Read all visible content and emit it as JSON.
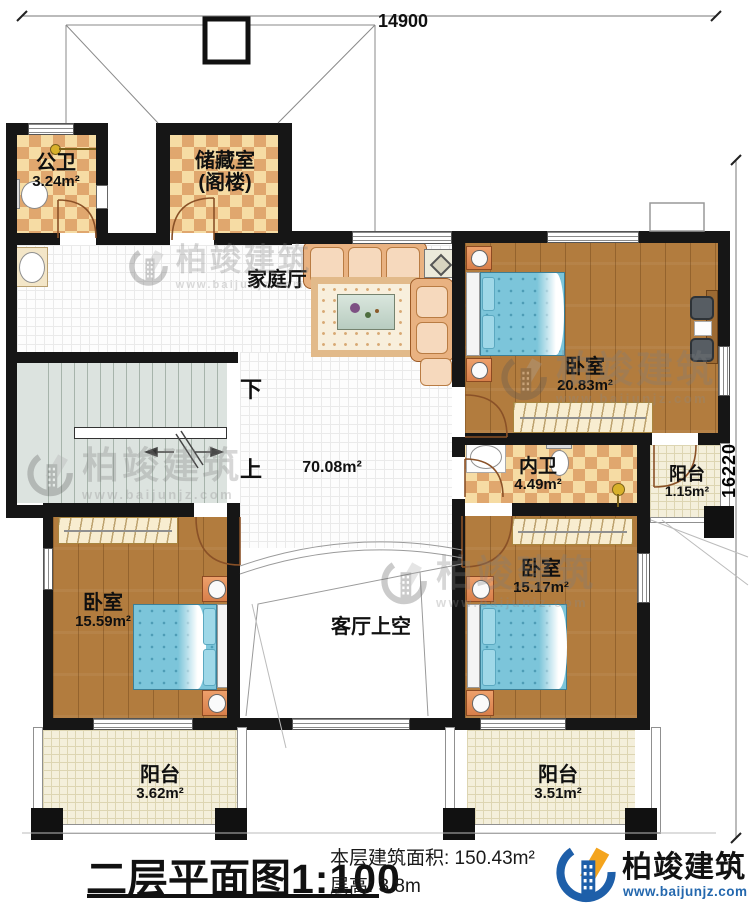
{
  "dims": {
    "top": "14900",
    "right": "16220"
  },
  "rooms": {
    "gongwei": {
      "name": "公卫",
      "area": "3.24m²"
    },
    "chucang": {
      "name": "储藏室",
      "sub": "(阁楼)"
    },
    "jiating": {
      "name": "家庭厅"
    },
    "hall": {
      "area": "70.08m²"
    },
    "bed_tr": {
      "name": "卧室",
      "area": "20.83m²"
    },
    "neiwei": {
      "name": "内卫",
      "area": "4.49m²"
    },
    "yt_r": {
      "name": "阳台",
      "area": "1.15m²"
    },
    "bed_bl": {
      "name": "卧室",
      "area": "15.59m²"
    },
    "bed_br": {
      "name": "卧室",
      "area": "15.17m²"
    },
    "keting": {
      "name": "客厅上空"
    },
    "yt_bl": {
      "name": "阳台",
      "area": "3.62m²"
    },
    "yt_br": {
      "name": "阳台",
      "area": "3.51m²"
    }
  },
  "stairs": {
    "down": "下",
    "up": "上"
  },
  "title": {
    "main": "二层平面图",
    "scale": "1:100",
    "area_label": "本层建筑面积: 150.43m²",
    "height_label": "层高: 3.8m"
  },
  "brand": {
    "name": "柏竣建筑",
    "url": "www.baijunjz.com"
  },
  "colors": {
    "wall": "#161616",
    "wood": "#b27c3e",
    "checker": "#e0a76e",
    "stair": "#dce3df",
    "bed": "#7cc5da",
    "brand_blue": "#1e5fa9",
    "brand_orange": "#f4a41d"
  }
}
